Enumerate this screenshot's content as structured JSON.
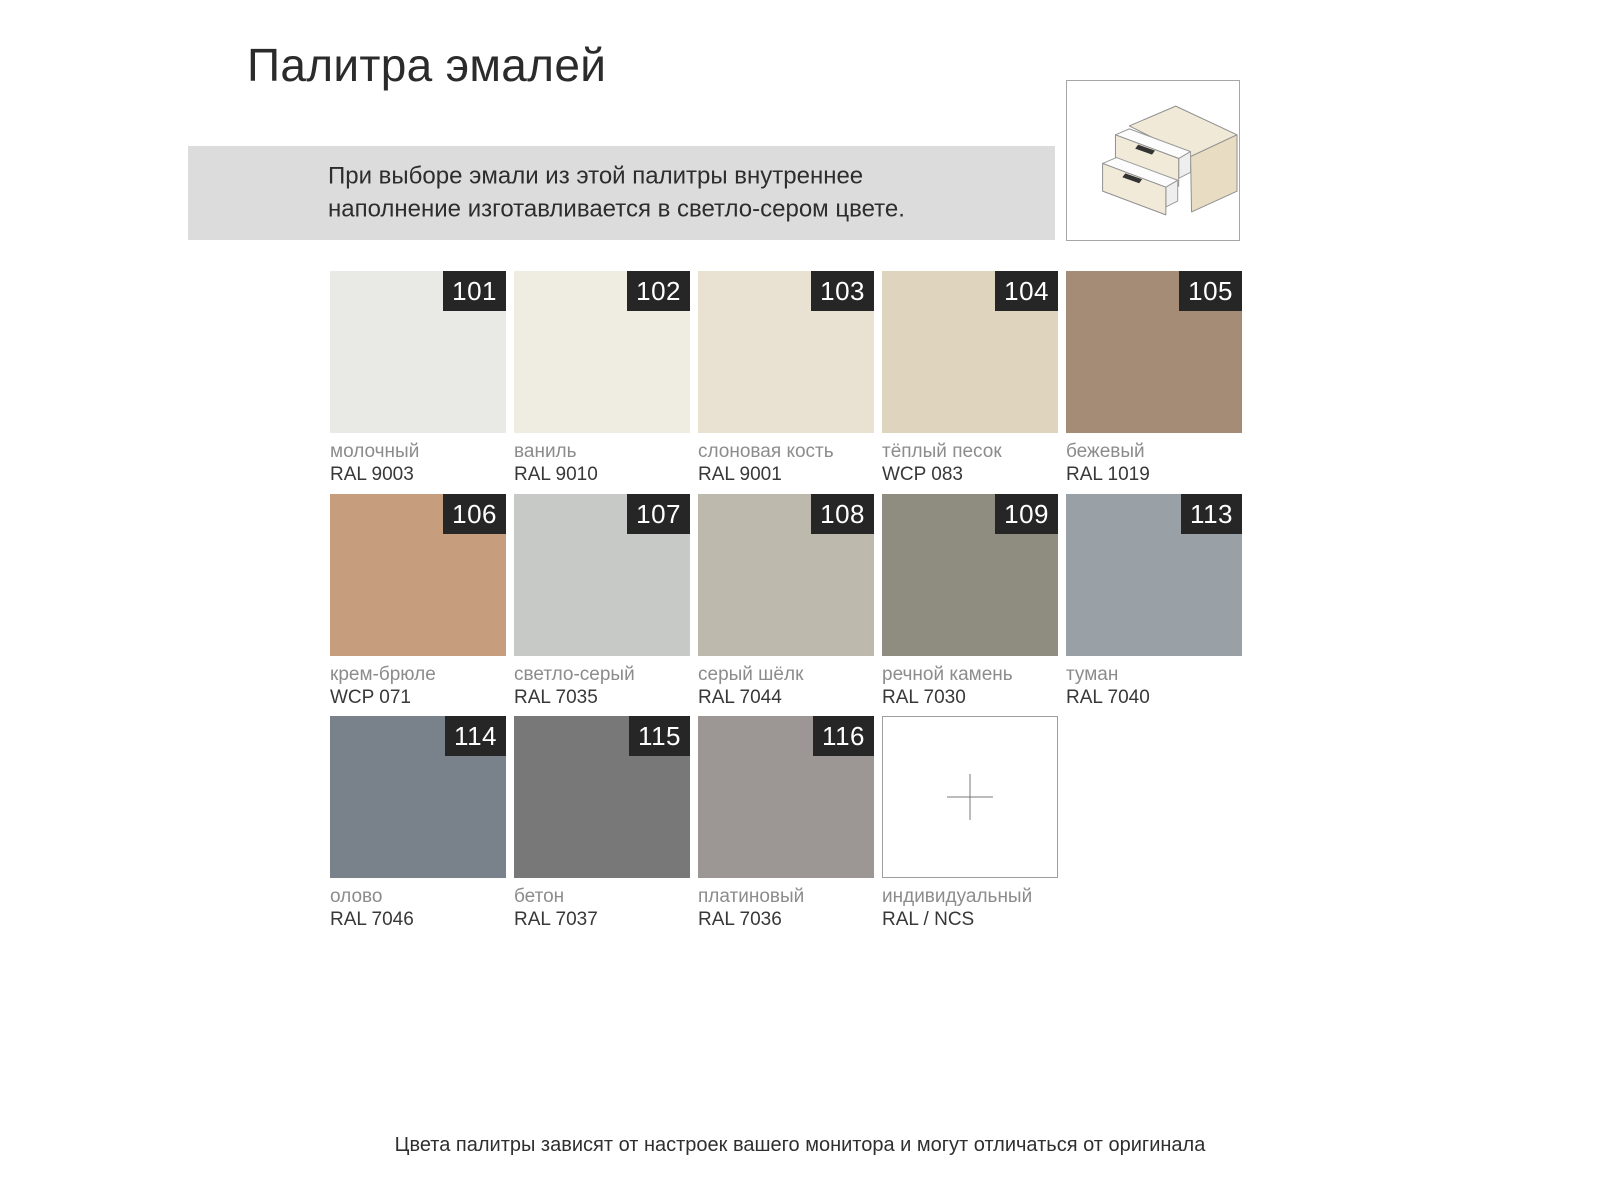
{
  "page": {
    "title": "Палитра эмалей",
    "note": "При выборе эмали из этой палитры внутреннее наполнение изготавливается в светло-сером цвете.",
    "footer": "Цвета палитры зависят от настроек вашего монитора и могут отличаться от оригинала"
  },
  "icons": {
    "drawer_illustration": "two-drawer-cabinet-icon",
    "custom_swatch": "plus-icon"
  },
  "colors": {
    "badge_background": "#262626",
    "badge_text": "#ffffff",
    "note_background": "#dcdcdc",
    "custom_swatch_border": "#9e9e9e"
  },
  "palette": {
    "swatches": [
      {
        "number": "101",
        "name": "молочный",
        "code": "RAL 9003",
        "color": "#e9eae5"
      },
      {
        "number": "102",
        "name": "ваниль",
        "code": "RAL 9010",
        "color": "#efede2"
      },
      {
        "number": "103",
        "name": "слоновая кость",
        "code": "RAL 9001",
        "color": "#e9e2d2"
      },
      {
        "number": "104",
        "name": "тёплый песок",
        "code": "WCP 083",
        "color": "#dfd4bd"
      },
      {
        "number": "105",
        "name": "бежевый",
        "code": "RAL 1019",
        "color": "#a58c76"
      },
      {
        "number": "106",
        "name": "крем-брюле",
        "code": "WCP 071",
        "color": "#c69e7e"
      },
      {
        "number": "107",
        "name": "светло-серый",
        "code": "RAL 7035",
        "color": "#c6c9c6"
      },
      {
        "number": "108",
        "name": "серый шёлк",
        "code": "RAL 7044",
        "color": "#bdb9ac"
      },
      {
        "number": "109",
        "name": "речной камень",
        "code": "RAL 7030",
        "color": "#8e8d80"
      },
      {
        "number": "113",
        "name": "туман",
        "code": "RAL 7040",
        "color": "#99a0a6"
      },
      {
        "number": "114",
        "name": "олово",
        "code": "RAL 7046",
        "color": "#79828a"
      },
      {
        "number": "115",
        "name": "бетон",
        "code": "RAL 7037",
        "color": "#787878"
      },
      {
        "number": "116",
        "name": "платиновый",
        "code": "RAL 7036",
        "color": "#9c9695"
      },
      {
        "number": null,
        "name": "индивидуальный",
        "code": "RAL / NCS",
        "color": "#ffffff",
        "custom": true
      }
    ]
  }
}
